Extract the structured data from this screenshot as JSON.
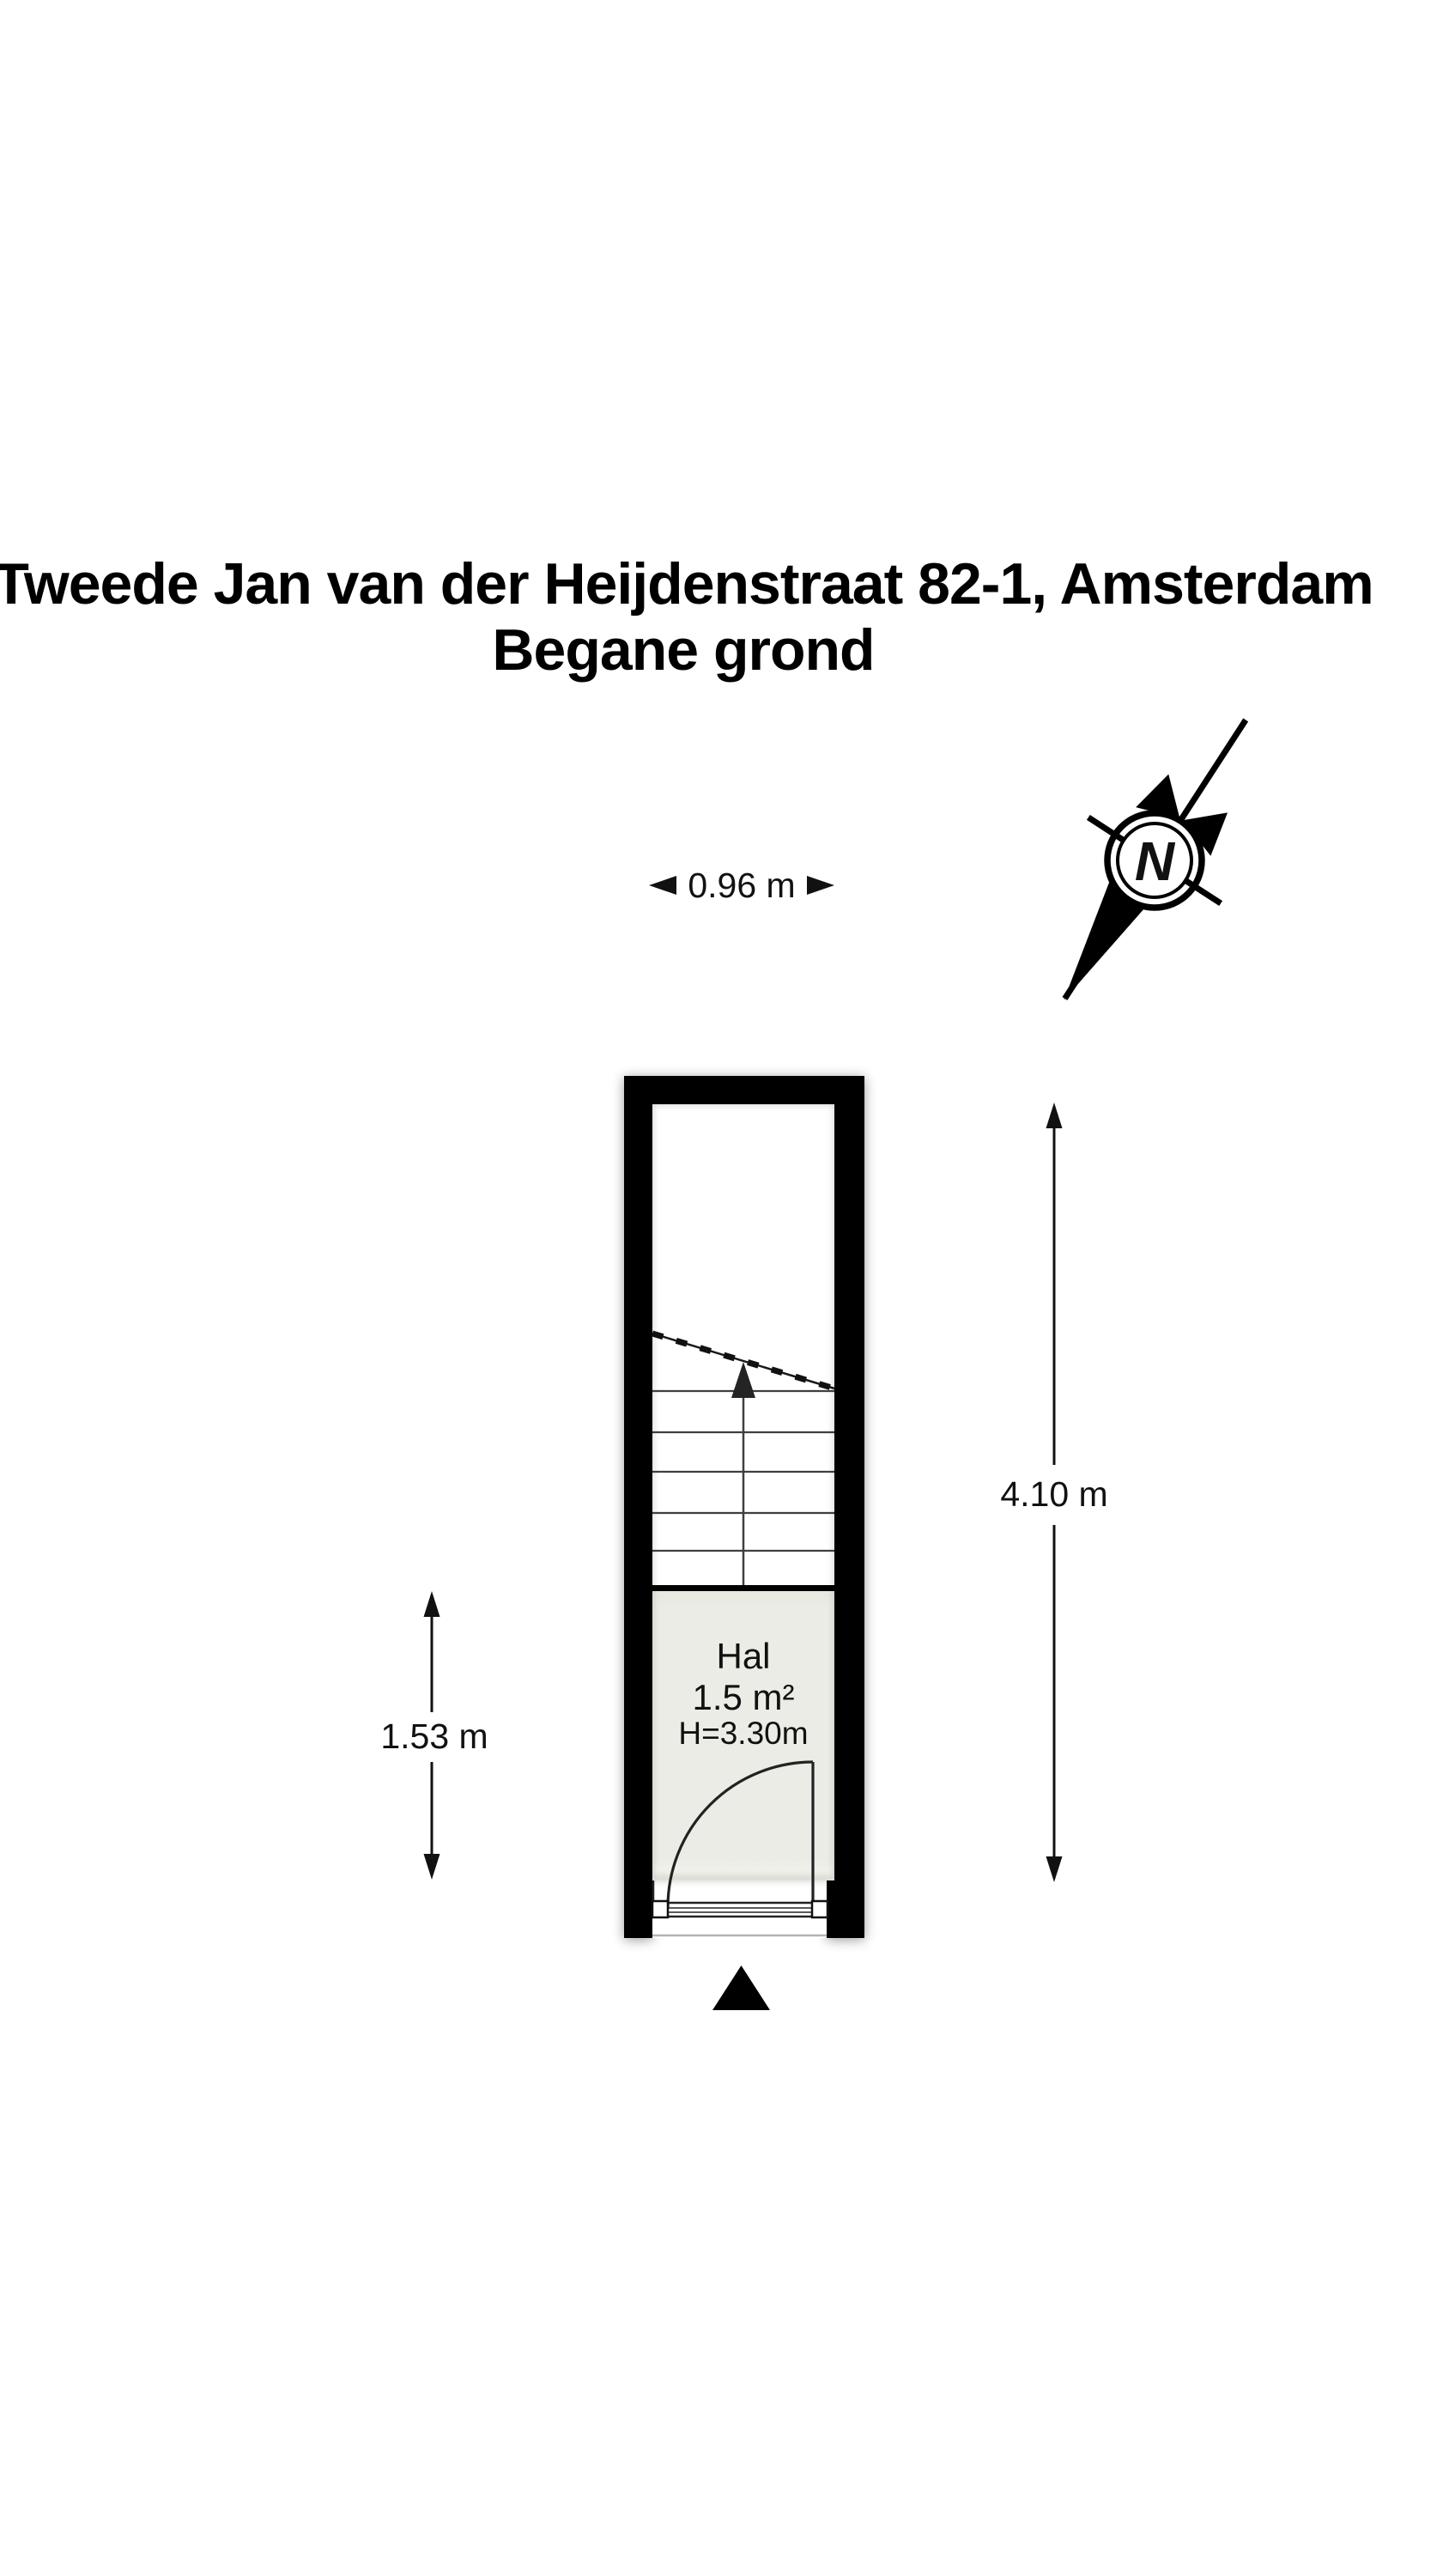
{
  "title": {
    "line1": "Tweede Jan van der Heijdenstraat 82-1, Amsterdam",
    "line2": "Begane grond"
  },
  "plan": {
    "room": {
      "name": "Hal",
      "area": "1.5 m²",
      "height": "H=3.30m"
    },
    "dimensions": {
      "width_label": "0.96 m",
      "depth_label": "4.10 m",
      "hall_depth_label": "1.53 m"
    },
    "compass": {
      "north_label": "N"
    },
    "colors": {
      "wall": "#000000",
      "floor": "#ecece6",
      "line": "#1a1a1a",
      "background": "#ffffff"
    }
  }
}
